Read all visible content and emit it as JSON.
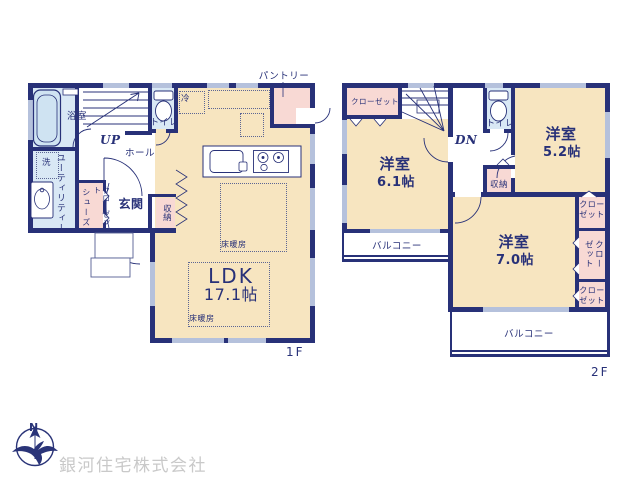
{
  "floor1": {
    "label": "1F",
    "ldk": "LDK",
    "ldk_size": "17.1帖",
    "entrance": "玄関",
    "hall": "ホール",
    "bath": "浴室",
    "utility": "ユーティリティー",
    "toilet": "トイレ",
    "pantry": "パントリー",
    "storage": "収納",
    "shoes_closet_line1": "シューズ",
    "shoes_closet_line2": "クローゼット",
    "laundry": "洗",
    "fridge": "冷",
    "floor_heating": "床暖房",
    "stairs": "UP"
  },
  "floor2": {
    "label": "2F",
    "room_61": "洋室",
    "room_61_size": "6.1帖",
    "room_52": "洋室",
    "room_52_size": "5.2帖",
    "room_70": "洋室",
    "room_70_size": "7.0帖",
    "closet": "クローゼット",
    "toilet": "トイレ",
    "storage": "収納",
    "balcony": "バルコニー",
    "stairs": "DN"
  },
  "footer": {
    "company": "銀河住宅株式会社",
    "compass_north": "N"
  },
  "colors": {
    "wall": "#283178",
    "room_beige": "#f7e5c0",
    "closet_pink": "#f8d9d4",
    "water_blue": "#d9e8f5",
    "window": "#b5c1dc",
    "company_text": "#c9c9c9"
  }
}
